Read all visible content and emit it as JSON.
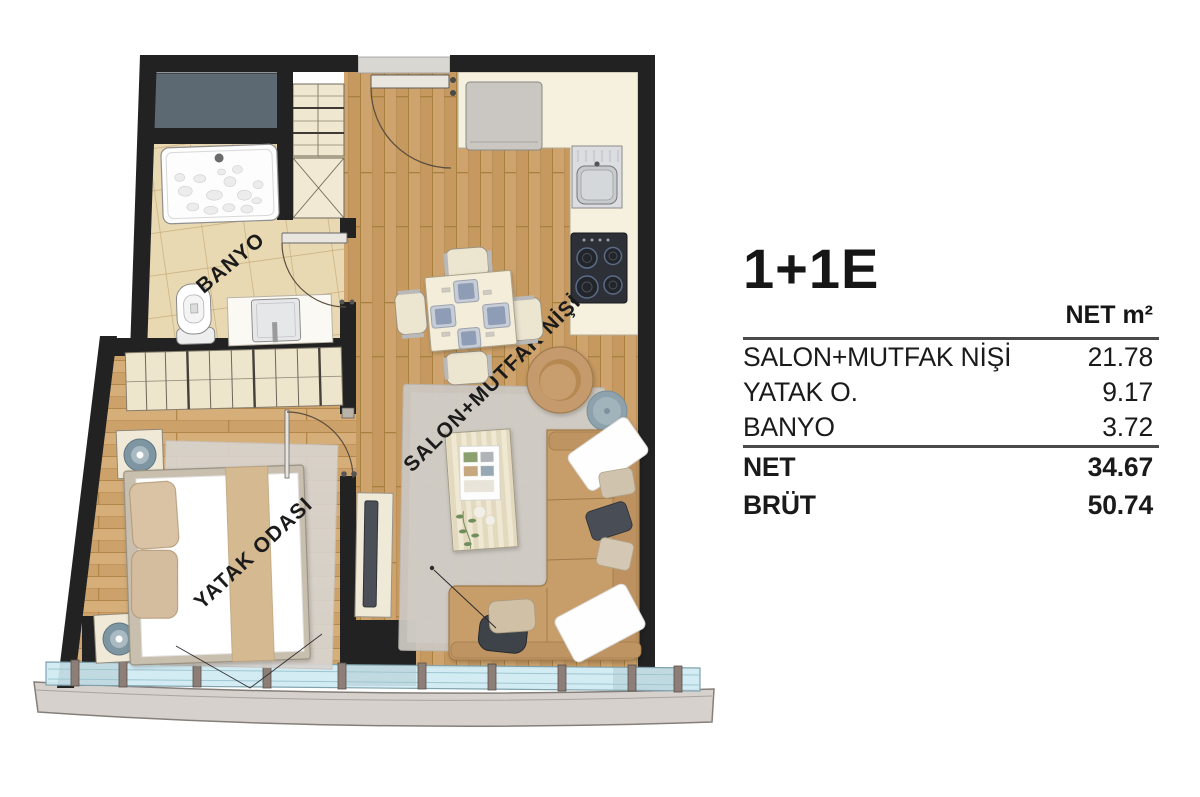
{
  "panel": {
    "title": "1+1E",
    "table": {
      "header": "NET m²",
      "rows": [
        {
          "label": "SALON+MUTFAK NİŞİ",
          "value": "21.78"
        },
        {
          "label": "YATAK O.",
          "value": "9.17"
        },
        {
          "label": "BANYO",
          "value": "3.72"
        },
        {
          "label": "NET",
          "value": "34.67"
        },
        {
          "label": "BRÜT",
          "value": "50.74"
        }
      ]
    }
  },
  "floorplan": {
    "labels": {
      "bathroom": "BANYO",
      "bedroom": "YATAK ODASI",
      "living": "SALON+MUTFAK NİŞİ"
    },
    "colors": {
      "wall": "#222222",
      "wood": "#cfa36d",
      "wood_bedroom": "#d6ae7a",
      "tile": "#e9d9b3",
      "counter": "#f6f1de",
      "glass": "#cfeaf3",
      "sofa": "#c79d6b",
      "shaft": "#5c6973",
      "ledge": "#d6d1cd",
      "lamp": "#7d96a2"
    }
  }
}
